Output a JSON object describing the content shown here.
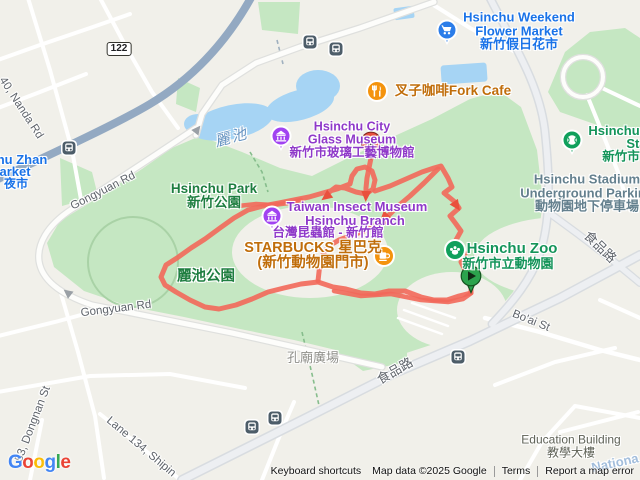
{
  "map": {
    "attribution": {
      "keyboard": "Keyboard shortcuts",
      "map_data": "Map data ©2025 Google",
      "terms": "Terms",
      "report": "Report a map error"
    },
    "logo_letters": [
      {
        "ch": "G",
        "c": "#4285F4"
      },
      {
        "ch": "o",
        "c": "#EA4335"
      },
      {
        "ch": "o",
        "c": "#FBBC05"
      },
      {
        "ch": "g",
        "c": "#4285F4"
      },
      {
        "ch": "l",
        "c": "#34A853"
      },
      {
        "ch": "e",
        "c": "#EA4335"
      }
    ],
    "route": {
      "color": "#F2685A",
      "arrow_color": "#E9513D",
      "width": 5,
      "opacity": 0.9,
      "segments": [
        {
          "w": 5,
          "pts": [
            [
              471,
              293
            ],
            [
              459,
              296
            ],
            [
              447,
              300
            ],
            [
              434,
              300
            ],
            [
              421,
              297
            ],
            [
              405,
              291
            ],
            [
              389,
              291
            ],
            [
              375,
              294
            ],
            [
              361,
              293
            ],
            [
              346,
              289
            ],
            [
              333,
              287
            ],
            [
              318,
              282
            ],
            [
              301,
              284
            ],
            [
              284,
              288
            ],
            [
              268,
              292
            ],
            [
              252,
              299
            ],
            [
              236,
              305
            ],
            [
              219,
              309
            ],
            [
              205,
              307
            ],
            [
              190,
              300
            ],
            [
              176,
              292
            ],
            [
              165,
              285
            ],
            [
              161,
              277
            ],
            [
              166,
              265
            ],
            [
              177,
              258
            ],
            [
              191,
              248
            ],
            [
              205,
              239
            ],
            [
              220,
              228
            ],
            [
              234,
              218
            ],
            [
              248,
              210
            ],
            [
              263,
              206
            ],
            [
              279,
              203
            ],
            [
              294,
              200
            ],
            [
              309,
              197
            ],
            [
              323,
              193
            ],
            [
              337,
              189
            ],
            [
              350,
              184
            ],
            [
              352,
              176
            ],
            [
              357,
              169
            ],
            [
              365,
              167
            ],
            [
              372,
              171
            ],
            [
              375,
              180
            ],
            [
              373,
              189
            ],
            [
              366,
              194
            ],
            [
              356,
              192
            ],
            [
              345,
              188
            ],
            [
              336,
              187
            ],
            [
              328,
              193
            ]
          ]
        },
        {
          "w": 5,
          "pts": [
            [
              371,
              158
            ],
            [
              369,
              168
            ],
            [
              367,
              178
            ],
            [
              366,
              188
            ],
            [
              366,
              193
            ]
          ]
        },
        {
          "w": 5,
          "pts": [
            [
              375,
              191
            ],
            [
              390,
              186
            ],
            [
              406,
              179
            ],
            [
              422,
              172
            ],
            [
              434,
              168
            ],
            [
              441,
              166
            ],
            [
              448,
              178
            ],
            [
              452,
              187
            ],
            [
              444,
              193
            ],
            [
              455,
              202
            ],
            [
              459,
              208
            ],
            [
              450,
              216
            ],
            [
              456,
              224
            ],
            [
              461,
              231
            ],
            [
              456,
              240
            ],
            [
              460,
              247
            ],
            [
              465,
              254
            ],
            [
              461,
              262
            ],
            [
              465,
              270
            ],
            [
              469,
              276
            ],
            [
              471,
              283
            ],
            [
              471,
              293
            ]
          ]
        },
        {
          "w": 5,
          "pts": [
            [
              438,
              169
            ],
            [
              424,
              183
            ],
            [
              410,
              196
            ],
            [
              397,
              207
            ],
            [
              387,
              217
            ]
          ]
        },
        {
          "w": 5,
          "pts": [
            [
              384,
              221
            ],
            [
              369,
              229
            ],
            [
              353,
              235
            ],
            [
              339,
              240
            ],
            [
              329,
              246
            ],
            [
              323,
              254
            ],
            [
              320,
              263
            ],
            [
              319,
              272
            ],
            [
              318,
              281
            ]
          ]
        },
        {
          "w": 4.5,
          "pts": [
            [
              238,
              206
            ],
            [
              256,
              204
            ],
            [
              273,
              205
            ],
            [
              289,
              203
            ],
            [
              301,
              200
            ]
          ]
        },
        {
          "w": 4.5,
          "pts": [
            [
              334,
              291
            ],
            [
              361,
              296
            ],
            [
              391,
              294
            ],
            [
              421,
              300
            ],
            [
              448,
              302
            ],
            [
              463,
              299
            ],
            [
              470,
              294
            ]
          ]
        }
      ],
      "arrows": [
        {
          "x": 385,
          "y": 220,
          "a": 135,
          "s": 1.5
        },
        {
          "x": 327,
          "y": 196,
          "a": 143,
          "s": 1
        },
        {
          "x": 366,
          "y": 195,
          "a": 93,
          "s": 1
        },
        {
          "x": 456,
          "y": 205,
          "a": 56,
          "s": 1
        }
      ],
      "start_pin": {
        "name": "route-start-pin",
        "x": 471,
        "y": 276,
        "fill": "#2CA34D",
        "stroke": "#14521F"
      },
      "end_pin": {
        "name": "route-end-pin",
        "x": 371,
        "y": 142,
        "fill": "#E8503F",
        "stroke": "#7F241B"
      }
    },
    "road_arrows": [
      {
        "x": 197,
        "y": 130,
        "a": -52
      },
      {
        "x": 68,
        "y": 293,
        "a": -142
      }
    ],
    "icons": [
      {
        "name": "flower-market-pin-icon",
        "shape": "pin",
        "glyph": "cart",
        "x": 447,
        "y": 30,
        "color": "#2B7DE9"
      },
      {
        "name": "fork-cafe-icon",
        "shape": "circle",
        "glyph": "restaurant",
        "x": 377,
        "y": 91,
        "color": "#F4930D"
      },
      {
        "name": "glass-museum-pin-icon",
        "shape": "pin",
        "glyph": "museum",
        "x": 281,
        "y": 136,
        "color": "#A143F1"
      },
      {
        "name": "insect-museum-pin-icon",
        "shape": "pin",
        "glyph": "museum",
        "x": 272,
        "y": 216,
        "color": "#A143F1"
      },
      {
        "name": "starbucks-coffee-icon",
        "shape": "circle",
        "glyph": "coffee",
        "x": 384,
        "y": 256,
        "color": "#F4930D"
      },
      {
        "name": "zoo-paw-icon",
        "shape": "circle",
        "glyph": "paw",
        "x": 455,
        "y": 250,
        "color": "#10A05C"
      },
      {
        "name": "stadium-pin-icon",
        "shape": "pin",
        "glyph": "baseball",
        "x": 572,
        "y": 140,
        "color": "#10A05C"
      },
      {
        "name": "train-station-icon",
        "shape": "square",
        "glyph": "train",
        "x": 69,
        "y": 148,
        "color": "#4D5D69"
      },
      {
        "name": "bus-stop-icon",
        "shape": "square",
        "glyph": "bus",
        "x": 310,
        "y": 42,
        "color": "#4D5D69"
      },
      {
        "name": "bus-stop-icon",
        "shape": "square",
        "glyph": "bus",
        "x": 336,
        "y": 49,
        "color": "#4D5D69"
      },
      {
        "name": "bus-stop-icon",
        "shape": "square",
        "glyph": "bus",
        "x": 252,
        "y": 427,
        "color": "#4D5D69"
      },
      {
        "name": "bus-stop-icon",
        "shape": "square",
        "glyph": "bus",
        "x": 275,
        "y": 418,
        "color": "#4D5D69"
      },
      {
        "name": "bus-stop-icon",
        "shape": "square",
        "glyph": "bus",
        "x": 458,
        "y": 357,
        "color": "#4D5D69"
      }
    ],
    "labels": [
      {
        "name": "flower-market-label",
        "lines": [
          "Hsinchu Weekend",
          "Flower Market",
          "新竹假日花市"
        ],
        "x": 519,
        "y": 31,
        "rot": 0,
        "color": "#1A73E8",
        "size": 13,
        "bold": true,
        "inter": true
      },
      {
        "name": "fork-cafe-label",
        "lines": [
          "叉子咖啡Fork Cafe"
        ],
        "x": 453,
        "y": 91,
        "rot": 0,
        "color": "#C06D0A",
        "size": 13.5,
        "bold": true,
        "inter": true
      },
      {
        "name": "glass-museum-label",
        "lines": [
          "Hsinchu City",
          "Glass Museum",
          "新竹市玻璃工藝博物館"
        ],
        "x": 352,
        "y": 140,
        "rot": 0,
        "color": "#8F39C9",
        "size": 12.5,
        "bold": true,
        "inter": true
      },
      {
        "name": "insect-museum-label-1",
        "lines": [
          "Taiwan Insect Museum"
        ],
        "x": 357,
        "y": 207,
        "rot": 0,
        "color": "#8F39C9",
        "size": 13,
        "bold": true,
        "inter": true
      },
      {
        "name": "insect-museum-label-2",
        "lines": [
          "Hsinchu Branch"
        ],
        "x": 355,
        "y": 221,
        "rot": 0,
        "color": "#8F39C9",
        "size": 13,
        "bold": true,
        "inter": true
      },
      {
        "name": "insect-museum-label-3",
        "lines": [
          "台灣昆蟲館 - 新竹館"
        ],
        "x": 328,
        "y": 233,
        "rot": 0,
        "color": "#8F39C9",
        "size": 12.5,
        "bold": true,
        "inter": true
      },
      {
        "name": "starbucks-label",
        "lines": [
          "STARBUCKS 星巴克",
          "(新竹動物園門市)"
        ],
        "x": 313,
        "y": 256,
        "rot": 0,
        "color": "#C06D0A",
        "size": 14.5,
        "bold": true,
        "inter": true
      },
      {
        "name": "zoo-label-1",
        "lines": [
          "Hsinchu Zoo"
        ],
        "x": 512,
        "y": 249,
        "rot": 0,
        "color": "#14945A",
        "size": 15,
        "bold": true,
        "inter": true
      },
      {
        "name": "zoo-label-2",
        "lines": [
          "新竹市立動物園"
        ],
        "x": 508,
        "y": 264,
        "rot": 0,
        "color": "#14945A",
        "size": 13,
        "bold": true,
        "inter": true
      },
      {
        "name": "stadium-label-1",
        "lines": [
          "Hsinchu"
        ],
        "x": 614,
        "y": 131,
        "rot": 0,
        "color": "#14945A",
        "size": 13,
        "bold": true,
        "inter": true
      },
      {
        "name": "stadium-label-2",
        "lines": [
          "Stadium"
        ],
        "x": 652,
        "y": 144,
        "rot": 0,
        "color": "#14945A",
        "size": 13,
        "bold": true,
        "inter": true
      },
      {
        "name": "stadium-label-3",
        "lines": [
          "新竹市"
        ],
        "x": 621,
        "y": 157,
        "rot": 0,
        "color": "#14945A",
        "size": 12.5,
        "bold": true,
        "inter": true
      },
      {
        "name": "underground-parking-label",
        "lines": [
          "Hsinchu Stadium",
          "Underground Parking",
          "動物園地下停車場"
        ],
        "x": 587,
        "y": 193,
        "rot": 0,
        "color": "#64808E",
        "size": 13,
        "bold": true,
        "inter": true
      },
      {
        "name": "hsinchu-park-label",
        "lines": [
          "Hsinchu Park",
          "新竹公園"
        ],
        "x": 214,
        "y": 196,
        "rot": 0,
        "color": "#1E7E40",
        "size": 13.5,
        "bold": true,
        "inter": true
      },
      {
        "name": "lichi-park-label",
        "lines": [
          "麗池公園"
        ],
        "x": 206,
        "y": 277,
        "rot": 0,
        "color": "#1E7E40",
        "size": 14.5,
        "bold": true,
        "inter": true
      },
      {
        "name": "pond-label",
        "lines": [
          "麗池"
        ],
        "x": 232,
        "y": 139,
        "rot": -15,
        "color": "#6593C1",
        "size": 15,
        "bold": false,
        "inter": false,
        "cls": "water"
      },
      {
        "name": "zhan-market-label-1",
        "lines": [
          "hu Zhan"
        ],
        "x": 22,
        "y": 160,
        "rot": 0,
        "color": "#1A73E8",
        "size": 13,
        "bold": true,
        "inter": true
      },
      {
        "name": "zhan-market-label-2",
        "lines": [
          "arket"
        ],
        "x": 15,
        "y": 172,
        "rot": 0,
        "color": "#1A73E8",
        "size": 13,
        "bold": true,
        "inter": true
      },
      {
        "name": "zhan-market-label-3",
        "lines": [
          "夜市"
        ],
        "x": 16,
        "y": 184,
        "rot": 0,
        "color": "#1A73E8",
        "size": 12,
        "bold": true,
        "inter": true
      },
      {
        "name": "confucius-square-label",
        "lines": [
          "孔廟廣場"
        ],
        "x": 313,
        "y": 358,
        "rot": 0,
        "color": "#8F8F8A",
        "size": 13,
        "bold": false,
        "inter": false
      },
      {
        "name": "education-building-label",
        "lines": [
          "Education Building",
          "教學大樓"
        ],
        "x": 571,
        "y": 446,
        "rot": 0,
        "color": "#5F6257",
        "size": 12,
        "bold": false,
        "inter": false
      },
      {
        "name": "street-nanda-rd",
        "lines": [
          "40, Nanda Rd"
        ],
        "x": 21,
        "y": 108,
        "rot": 57,
        "color": "#5F646B",
        "size": 11.5,
        "bold": false,
        "inter": false
      },
      {
        "name": "street-gongyuan-rd-1",
        "lines": [
          "Gongyuan Rd"
        ],
        "x": 103,
        "y": 191,
        "rot": -27,
        "color": "#5F646B",
        "size": 11.5,
        "bold": false,
        "inter": false
      },
      {
        "name": "street-gongyuan-rd-2",
        "lines": [
          "Gongyuan Rd"
        ],
        "x": 116,
        "y": 309,
        "rot": -7,
        "color": "#5F646B",
        "size": 11.5,
        "bold": false,
        "inter": false
      },
      {
        "name": "street-dongnan-st",
        "lines": [
          "53, Dongnan St"
        ],
        "x": 33,
        "y": 424,
        "rot": -69,
        "color": "#5F646B",
        "size": 11.5,
        "bold": false,
        "inter": false
      },
      {
        "name": "street-lane-134",
        "lines": [
          "Lane 134, Shipin"
        ],
        "x": 141,
        "y": 447,
        "rot": 40,
        "color": "#5F646B",
        "size": 11.5,
        "bold": false,
        "inter": false
      },
      {
        "name": "street-shipin-rd-1",
        "lines": [
          "食品路"
        ],
        "x": 395,
        "y": 371,
        "rot": -30,
        "color": "#5F646B",
        "size": 13,
        "bold": false,
        "inter": false
      },
      {
        "name": "street-shipin-rd-2",
        "lines": [
          "食品路"
        ],
        "x": 600,
        "y": 247,
        "rot": 44,
        "color": "#5F646B",
        "size": 13,
        "bold": false,
        "inter": false
      },
      {
        "name": "street-boai-st",
        "lines": [
          "Bo'ai St"
        ],
        "x": 531,
        "y": 321,
        "rot": 22,
        "color": "#5F646B",
        "size": 11.5,
        "bold": false,
        "inter": false
      },
      {
        "name": "national-univ-label",
        "lines": [
          "Nationa"
        ],
        "x": 615,
        "y": 463,
        "rot": -12,
        "color": "#A3BEDC",
        "size": 13,
        "bold": true,
        "inter": false
      },
      {
        "name": "route-122-shield",
        "lines": [
          "122"
        ],
        "x": 119,
        "y": 49,
        "rot": 0,
        "color": "#202124",
        "size": 10,
        "bold": true,
        "inter": false,
        "cls": "shield"
      }
    ]
  }
}
